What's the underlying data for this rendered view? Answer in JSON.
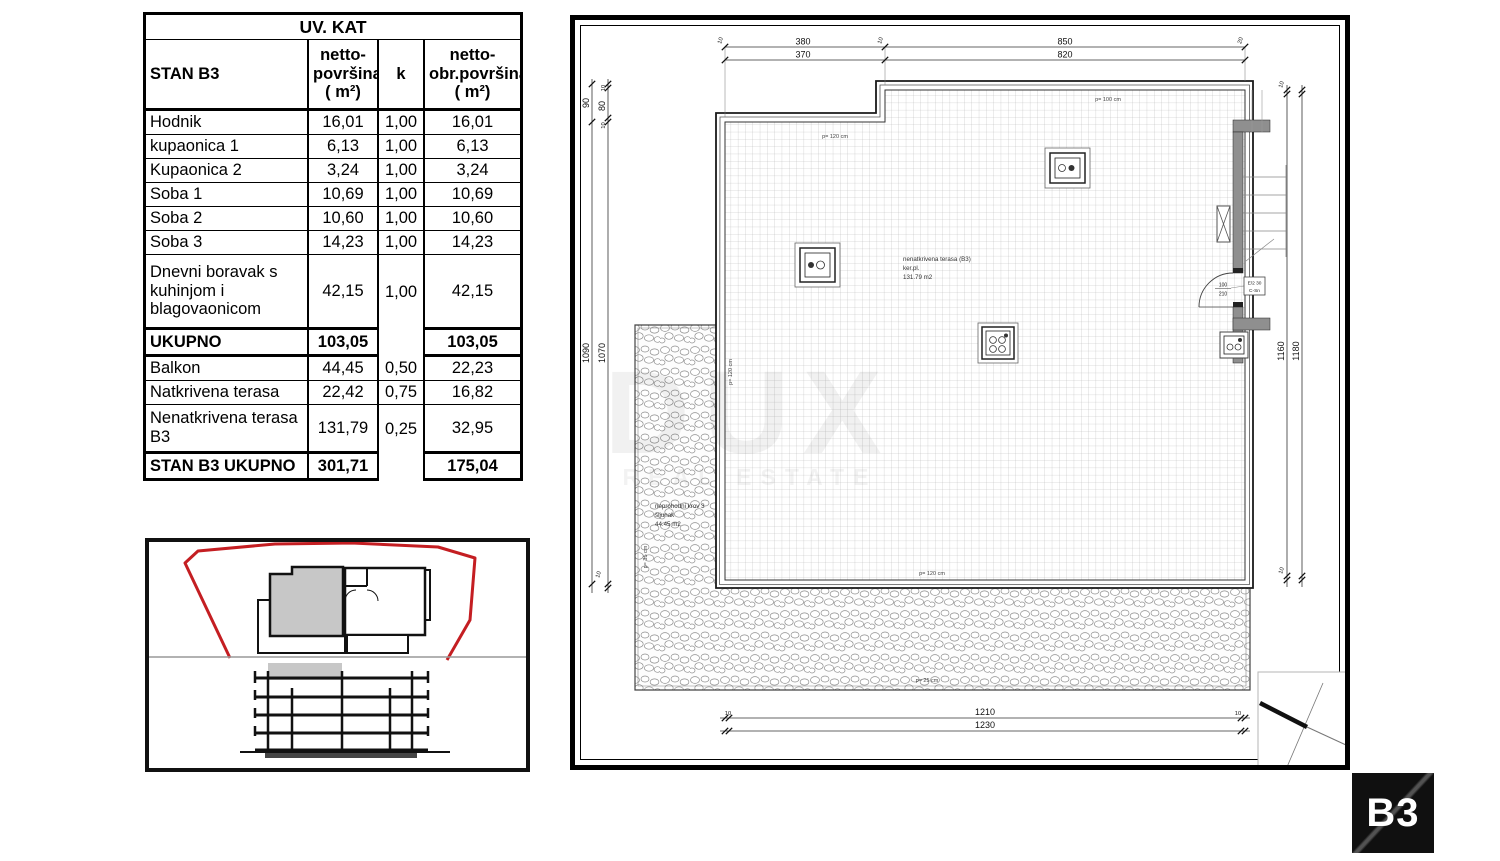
{
  "table": {
    "title": "UV. KAT",
    "header": {
      "stan": "STAN B3",
      "netto": "netto-\npovršina\n( m²)",
      "k": "k",
      "obr": "netto-\nobr.površina\n( m²)"
    },
    "rows": [
      {
        "name": "Hodnik",
        "netto": "16,01",
        "k": "1,00",
        "obr": "16,01"
      },
      {
        "name": "kupaonica 1",
        "netto": "6,13",
        "k": "1,00",
        "obr": "6,13"
      },
      {
        "name": "Kupaonica 2",
        "netto": "3,24",
        "k": "1,00",
        "obr": "3,24"
      },
      {
        "name": "Soba 1",
        "netto": "10,69",
        "k": "1,00",
        "obr": "10,69"
      },
      {
        "name": "Soba 2",
        "netto": "10,60",
        "k": "1,00",
        "obr": "10,60"
      },
      {
        "name": "Soba 3",
        "netto": "14,23",
        "k": "1,00",
        "obr": "14,23"
      },
      {
        "name": "Dnevni boravak s kuhinjom i blagovaonicom",
        "netto": "42,15",
        "k": "1,00",
        "obr": "42,15"
      }
    ],
    "total": {
      "name": "UKUPNO",
      "netto": "103,05",
      "obr": "103,05"
    },
    "extras": [
      {
        "name": "Balkon",
        "netto": "44,45",
        "k": "0,50",
        "obr": "22,23"
      },
      {
        "name": "Natkrivena terasa",
        "netto": "22,42",
        "k": "0,75",
        "obr": "16,82"
      },
      {
        "name": "Nenatkrivena  terasa B3",
        "netto": "131,79",
        "k": "0,25",
        "obr": "32,95"
      }
    ],
    "grand_total": {
      "name": "STAN B3 UKUPNO",
      "netto": "301,71",
      "obr": "175,04"
    }
  },
  "plan": {
    "labels": {
      "terrace_line1": "nenatkrivena terasa (B3)",
      "terrace_line2": "ker.pl.",
      "terrace_line3": "131.79   m2",
      "roof_line1": "neprohodni krov 3",
      "roof_line2": "šljunak",
      "roof_line3": "44.45    m2",
      "p_top": "p= 120 cm",
      "p_top_right": "p= 100 cm",
      "p_left": "p= 120 cm",
      "p_bottom": "p= 120 cm",
      "p_gravel_bottom": "p= 25 cm",
      "p_gravel_left": "p= 35 cm",
      "door_width": "100",
      "door_height": "210",
      "door_mark_line1": "E/2 30",
      "door_mark_line2": "C-Sn"
    },
    "dims": {
      "top_seg1_outer": "380",
      "top_seg1_inner": "370",
      "top_seg2_outer": "850",
      "top_seg2_inner": "820",
      "top_tick1": "10",
      "top_tick2": "10",
      "top_tick3": "20",
      "left_top_outer": "90",
      "left_top_t1": "10",
      "left_top_mid": "80",
      "left_top_t2": "10",
      "left_main_outer": "1090",
      "left_main_inner": "1070",
      "left_bottom_tick": "10",
      "right_top_tick": "10",
      "right_main_outer": "1160",
      "right_main_inner": "1180",
      "right_bottom_tick": "10",
      "bottom_tick_left": "10",
      "bottom_outer": "1210",
      "bottom_inner": "1230",
      "bottom_tick_right": "10"
    }
  },
  "watermark": {
    "line1": "DUX",
    "line2": "REAL ESTATE"
  },
  "badge": {
    "label": "B3"
  }
}
